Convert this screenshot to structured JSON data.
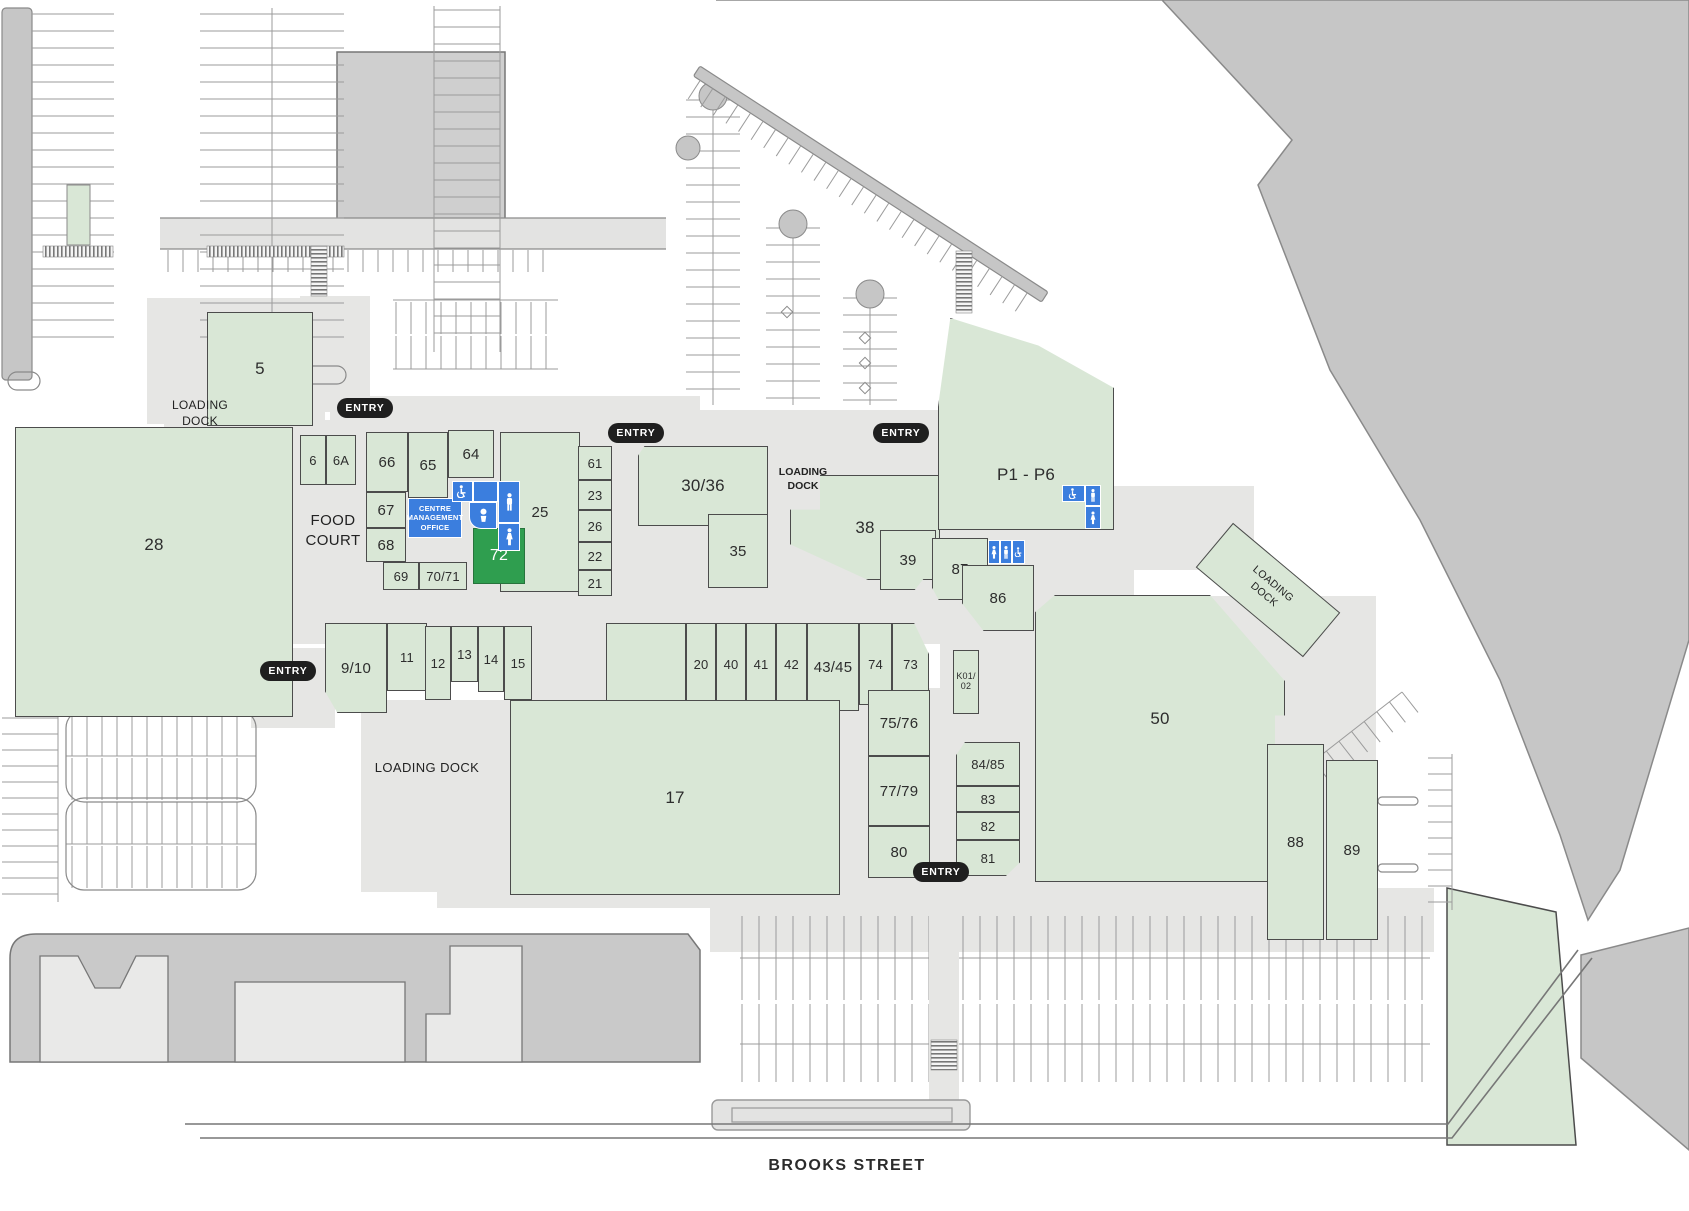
{
  "labels": {
    "entry": "ENTRY",
    "food_court": "FOOD COURT",
    "loading_dock": "LOADING DOCK",
    "centre_management_office": "CENTRE MANAGEMENT OFFICE",
    "street": "BROOKS STREET"
  },
  "colors": {
    "tenancy_green": "#d9e7d6",
    "highlight_green": "#2f9e4f",
    "facility_blue": "#3b7ede",
    "mall_grey": "#e6e6e4",
    "land_grey": "#c6c6c6",
    "entry_badge_black": "#1f1f1f"
  },
  "facilities": {
    "wheelchair": "wheelchair-accessible-toilet",
    "male": "male-toilet",
    "female": "female-toilet",
    "parents": "parents-room"
  },
  "stores": {
    "s5": {
      "label": "5"
    },
    "s6": {
      "label": "6"
    },
    "s6a": {
      "label": "6A"
    },
    "s28": {
      "label": "28"
    },
    "s66": {
      "label": "66"
    },
    "s65": {
      "label": "65"
    },
    "s64": {
      "label": "64"
    },
    "s67": {
      "label": "67"
    },
    "s68": {
      "label": "68"
    },
    "s69": {
      "label": "69"
    },
    "s70_71": {
      "label": "70/71"
    },
    "s72": {
      "label": "72"
    },
    "s25": {
      "label": "25"
    },
    "s61": {
      "label": "61"
    },
    "s23": {
      "label": "23"
    },
    "s26": {
      "label": "26"
    },
    "s22": {
      "label": "22"
    },
    "s21": {
      "label": "21"
    },
    "s30_36": {
      "label": "30/36"
    },
    "s35": {
      "label": "35"
    },
    "s38": {
      "label": "38"
    },
    "s39": {
      "label": "39"
    },
    "p1_p6": {
      "label": "P1 - P6"
    },
    "s87": {
      "label": "87"
    },
    "s86": {
      "label": "86"
    },
    "s9_10": {
      "label": "9/10"
    },
    "s11": {
      "label": "11"
    },
    "s12": {
      "label": "12"
    },
    "s13": {
      "label": "13"
    },
    "s14": {
      "label": "14"
    },
    "s15": {
      "label": "15"
    },
    "s20": {
      "label": "20"
    },
    "s40": {
      "label": "40"
    },
    "s41": {
      "label": "41"
    },
    "s42": {
      "label": "42"
    },
    "s43_45": {
      "label": "43/45"
    },
    "s74": {
      "label": "74"
    },
    "s73": {
      "label": "73"
    },
    "s17": {
      "label": "17"
    },
    "s75_76": {
      "label": "75/76"
    },
    "s77_79": {
      "label": "77/79"
    },
    "s80": {
      "label": "80"
    },
    "s84_85": {
      "label": "84/85"
    },
    "s83": {
      "label": "83"
    },
    "s82": {
      "label": "82"
    },
    "s81": {
      "label": "81"
    },
    "s50": {
      "label": "50"
    },
    "s88": {
      "label": "88"
    },
    "s89": {
      "label": "89"
    },
    "k01_02": {
      "label": "K01/02",
      "line1": "K01/",
      "line2": "02"
    }
  }
}
